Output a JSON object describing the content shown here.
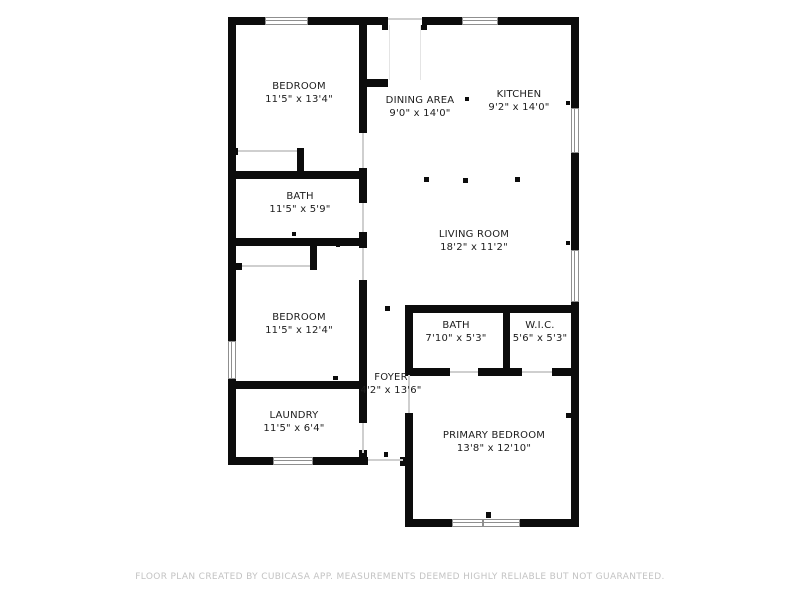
{
  "plan": {
    "rooms": [
      {
        "id": "bedroom-1",
        "name": "BEDROOM",
        "dims": "11'5\" x 13'4\""
      },
      {
        "id": "dining-area",
        "name": "DINING AREA",
        "dims": "9'0\" x 14'0\""
      },
      {
        "id": "kitchen",
        "name": "KITCHEN",
        "dims": "9'2\" x 14'0\""
      },
      {
        "id": "bath-1",
        "name": "BATH",
        "dims": "11'5\" x 5'9\""
      },
      {
        "id": "living-room",
        "name": "LIVING ROOM",
        "dims": "18'2\" x 11'2\""
      },
      {
        "id": "bedroom-2",
        "name": "BEDROOM",
        "dims": "11'5\" x 12'4\""
      },
      {
        "id": "bath-2",
        "name": "BATH",
        "dims": "7'10\" x 5'3\""
      },
      {
        "id": "wic",
        "name": "W.I.C.",
        "dims": "5'6\" x 5'3\""
      },
      {
        "id": "foyer",
        "name": "FOYER",
        "dims": "4'2\" x 13'6\""
      },
      {
        "id": "laundry",
        "name": "LAUNDRY",
        "dims": "11'5\" x 6'4\""
      },
      {
        "id": "primary-bedroom",
        "name": "PRIMARY BEDROOM",
        "dims": "13'8\" x 12'10\""
      }
    ],
    "footer": "FLOOR PLAN CREATED BY CUBICASA APP. MEASUREMENTS DEEMED HIGHLY RELIABLE BUT NOT GUARANTEED.",
    "colors": {
      "wall": "#0c0c0c",
      "text": "#1c1c1c",
      "footer_text": "#c3c3c3",
      "window_frame": "#8f8f8f",
      "opening_line": "#cfcfcf"
    }
  }
}
